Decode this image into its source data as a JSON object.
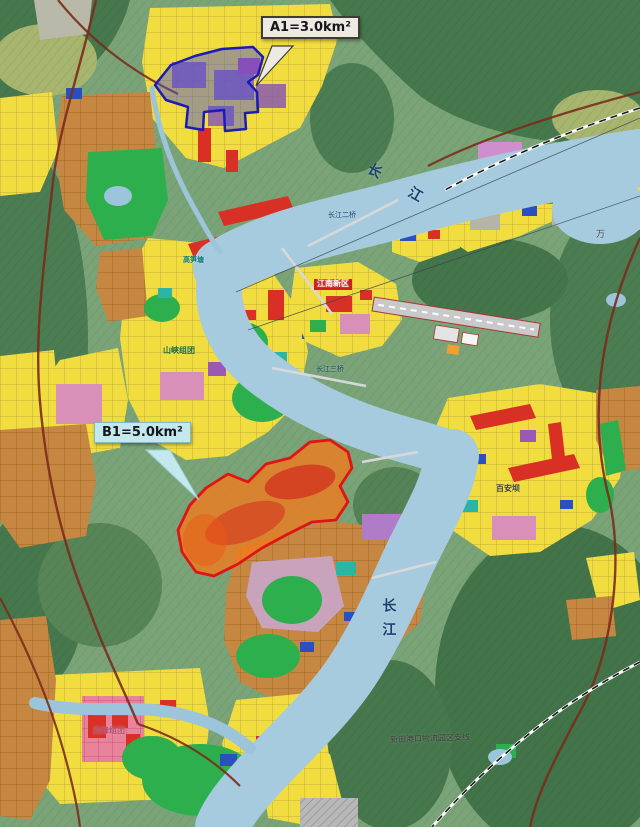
{
  "map": {
    "kind": "urban-land-use-planning-map",
    "annotations": {
      "a1": {
        "label": "A1=3.0km²",
        "zone_color": "#2a2ab8"
      },
      "b1": {
        "label": "B1=5.0km²",
        "zone_color": "#e01414"
      }
    },
    "labels": {
      "river_top": "长 江",
      "river_bottom": "长江",
      "bridge_2": "长江二桥",
      "bridge_3": "长江三桥",
      "jiangnan": "江南新区",
      "shanxia": "山峡组团",
      "gaosuntang": "高笋塘",
      "baianba": "百安坝",
      "gaofeng": "高峰组团",
      "xintian": "新田港口物流园区支线",
      "wan_edge": "万"
    },
    "colors": {
      "residential_yellow": "#f1dd3f",
      "village_brown": "#c68742",
      "commercial_red": "#d93025",
      "park_green": "#2eaf4e",
      "water_blue": "#a6cbdf",
      "terrain_green": "#7aa478",
      "zone_a1_fill": "rgba(70,80,215,0.45)",
      "zone_b1_fill": "rgba(242,122,28,0.78)"
    }
  }
}
